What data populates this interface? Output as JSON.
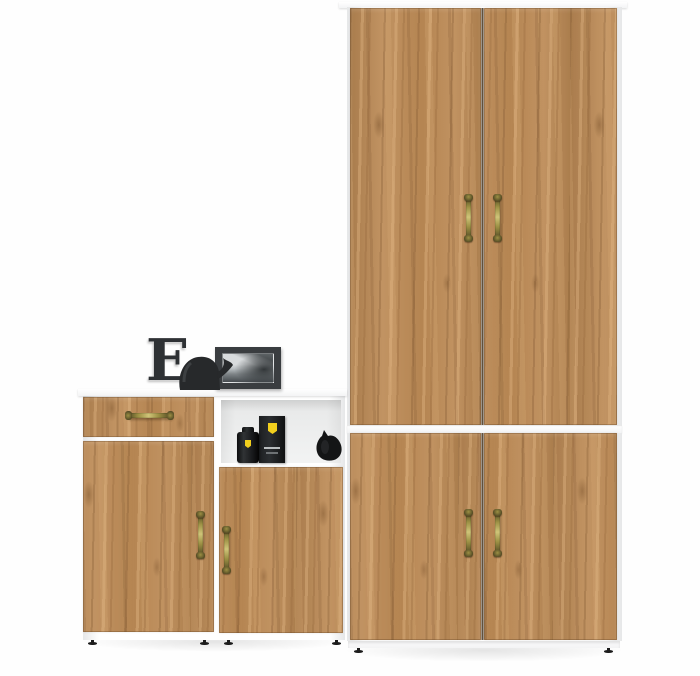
{
  "scene": {
    "description": "3D product render of a hallway furniture set: tall oak two-door wardrobe with lower two-door cabinet on the right, and a low sideboard (drawer unit plus open-shelf unit) on the left, all with white carcass and antique-brass spindle handles",
    "background_color": "#fefefe"
  },
  "colors": {
    "bg": "#fefefe",
    "panel_white": "#f3f4f5",
    "panel_edge": "#e6e7e8",
    "wood_base": "#bc8a55",
    "gap_dark": "#4a3823",
    "brass_dark": "#4a4120",
    "brass_mid": "#9c9044",
    "brass_light": "#cfc478",
    "decor_dark": "#2e3134",
    "frame_gray": "#3a3d40",
    "photo_sky": "#d8dbdd",
    "photo_dark": "#454a4e",
    "shield_yellow": "#f2cf1d",
    "foot_black": "#1c1c1c",
    "shelf_back": "#e7e8e8"
  },
  "furniture": {
    "wardrobe": {
      "label": "tall two-door wardrobe",
      "door_count": 2,
      "handle_style": "antique-brass-spindle",
      "handle_count": 2
    },
    "lower_cabinet": {
      "label": "two-door base cabinet",
      "door_count": 2,
      "handle_count": 2
    },
    "sideboard_drawer_unit": {
      "label": "cabinet with one drawer and one door",
      "drawer_count": 1,
      "door_count": 1,
      "handle_count": 2
    },
    "sideboard_shelf_unit": {
      "label": "cabinet with open shelf niche and one door",
      "door_count": 1,
      "handle_count": 1
    },
    "feet": {
      "style": "small black adjustable feet",
      "count": 8
    }
  },
  "decor": {
    "letter_e": "E",
    "items": [
      {
        "name": "decorative-letter",
        "text": "E",
        "color": "dark charcoal"
      },
      {
        "name": "elephant-figurine",
        "color": "glossy dark charcoal"
      },
      {
        "name": "photo-frame",
        "content": "black-and-white seascape photo"
      },
      {
        "name": "perfume-bottle",
        "accent": "yellow shield badge"
      },
      {
        "name": "perfume-box",
        "accent": "yellow shield badge"
      },
      {
        "name": "black-figurine",
        "color": "black"
      }
    ]
  }
}
